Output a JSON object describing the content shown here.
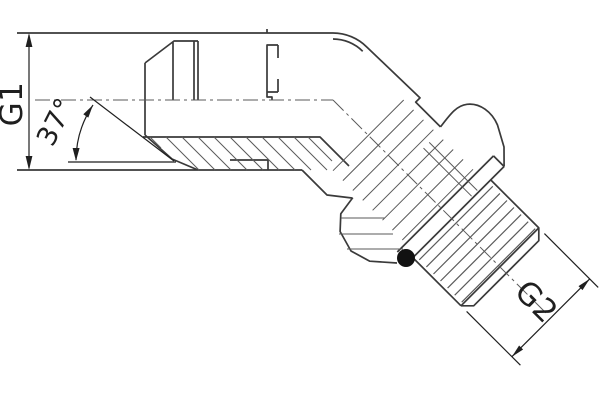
{
  "drawing": {
    "labels": {
      "g1": "G1",
      "angle": "37°",
      "g2": "G2"
    },
    "colors": {
      "background": "#ffffff",
      "outline": "#3a3a3a",
      "thin_line": "#5a5a5a",
      "annotation": "#1f1f1f",
      "oring_fill": "#111111"
    }
  }
}
